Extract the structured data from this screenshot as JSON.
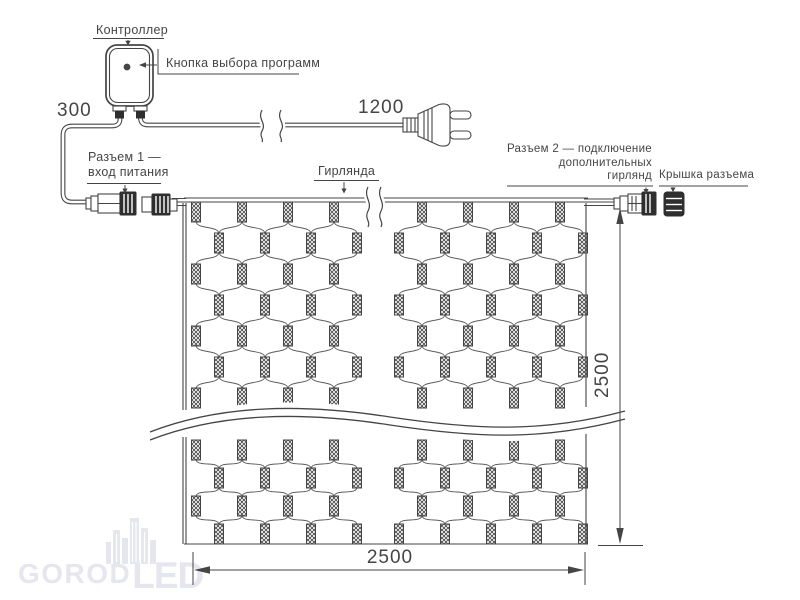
{
  "colors": {
    "ink": "#454545",
    "dark": "#2f2f2f",
    "watermark": "#e6e6ee"
  },
  "labels": {
    "controller": "Контроллер",
    "program_button": "Кнопка выбора программ",
    "connector1_line1": "Разъем 1 —",
    "connector1_line2": "вход питания",
    "garland": "Гирлянда",
    "connector2_line1": "Разъем 2 — подключение",
    "connector2_line2": "дополнительных",
    "connector2_line3": "гирлянд",
    "connector_cap": "Крышка разъема"
  },
  "dimensions": {
    "controller_cable": "300",
    "power_cord": "1200",
    "net_height": "2500",
    "net_width": "2500"
  },
  "watermark": {
    "text_goro": "GOROD",
    "text_led": "LED"
  }
}
